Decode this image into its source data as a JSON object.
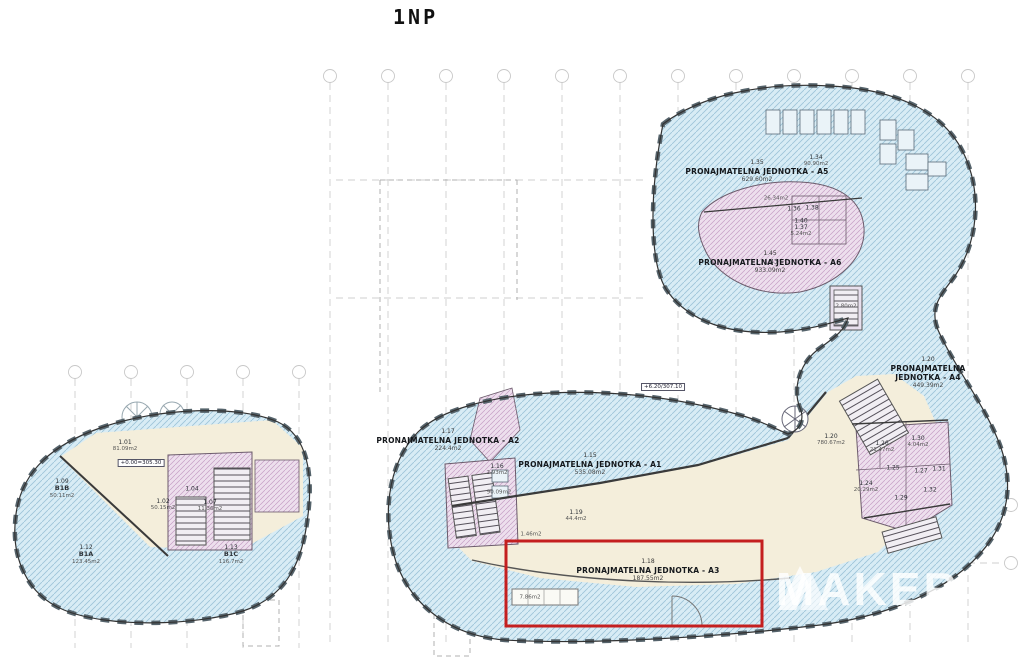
{
  "title": "1NP",
  "watermark": "MAKER",
  "colors": {
    "hatch_blue_bg": "#d8ecf5",
    "hatch_blue_line": "#9cc3d8",
    "cream": "#f4eedb",
    "hatch_pink_bg": "#eddfed",
    "hatch_pink_line": "#c59fc5",
    "wall": "#3a3a3a",
    "highlight_red": "#c41f1f",
    "grid": "#cfcfcf"
  },
  "units": [
    {
      "code": "1.35",
      "name": "PRONAJMATELNA JEDNOTKA - A5",
      "area": "629.60m2"
    },
    {
      "code": "1.45",
      "name": "PRONAJMATELNA JEDNOTKA - A6",
      "area": "933.09m2"
    },
    {
      "code": "1.20",
      "name": "PRONAJMATELNA JEDNOTKA - A4",
      "area": "449.39m2"
    },
    {
      "code": "1.17",
      "name": "PRONAJMATELNA JEDNOTKA - A2",
      "area": "224.4m2"
    },
    {
      "code": "1.15",
      "name": "PRONAJMATELNA JEDNOTKA - A1",
      "area": "535.08m2"
    },
    {
      "code": "1.18",
      "name": "PRONAJMATELNA JEDNOTKA - A3",
      "area": "187.55m2"
    }
  ],
  "rooms": [
    {
      "code": "1.01",
      "name": "",
      "area": "81.09m2"
    },
    {
      "code": "1.09",
      "name": "B1B",
      "area": "50.11m2"
    },
    {
      "code": "1.12",
      "name": "B1A",
      "area": "123.45m2"
    },
    {
      "code": "1.13",
      "name": "B1C",
      "area": "116.7m2"
    },
    {
      "code": "1.02",
      "name": "",
      "area": "50.15m2"
    },
    {
      "code": "1.07",
      "name": "",
      "area": "11.36m2"
    },
    {
      "code": "1.04",
      "name": "",
      "area": ""
    },
    {
      "code": "1.34",
      "name": "",
      "area": "90.90m2"
    },
    {
      "code": "1.37",
      "name": "",
      "area": "5.24m2"
    },
    {
      "code": "",
      "name": "",
      "area": "26.34m2"
    },
    {
      "code": "1.43",
      "name": "",
      "area": ""
    },
    {
      "code": "1.36",
      "name": "",
      "area": ""
    },
    {
      "code": "1.38",
      "name": "",
      "area": ""
    },
    {
      "code": "1.40",
      "name": "",
      "area": ""
    },
    {
      "code": "1.20",
      "name": "",
      "area": "780.67m2"
    },
    {
      "code": "1.24",
      "name": "",
      "area": "20.29m2"
    },
    {
      "code": "1.26",
      "name": "",
      "area": "21.47m2"
    },
    {
      "code": "1.30",
      "name": "",
      "area": "4.04m2"
    },
    {
      "code": "1.25",
      "name": "",
      "area": ""
    },
    {
      "code": "1.27",
      "name": "",
      "area": ""
    },
    {
      "code": "1.31",
      "name": "",
      "area": ""
    },
    {
      "code": "1.32",
      "name": "",
      "area": ""
    },
    {
      "code": "1.29",
      "name": "",
      "area": ""
    },
    {
      "code": "1.19",
      "name": "",
      "area": "44.4m2"
    },
    {
      "code": "1.16",
      "name": "",
      "area": "2.93m2"
    },
    {
      "code": "",
      "name": "",
      "area": "90.09m2"
    },
    {
      "code": "",
      "name": "",
      "area": "7.86m2"
    },
    {
      "code": "",
      "name": "",
      "area": "1.46m2"
    },
    {
      "code": "",
      "name": "",
      "area": "2.80m2"
    }
  ],
  "elevations": [
    {
      "text": "+0.00=305.30"
    },
    {
      "text": "+6.20/307.10"
    }
  ]
}
